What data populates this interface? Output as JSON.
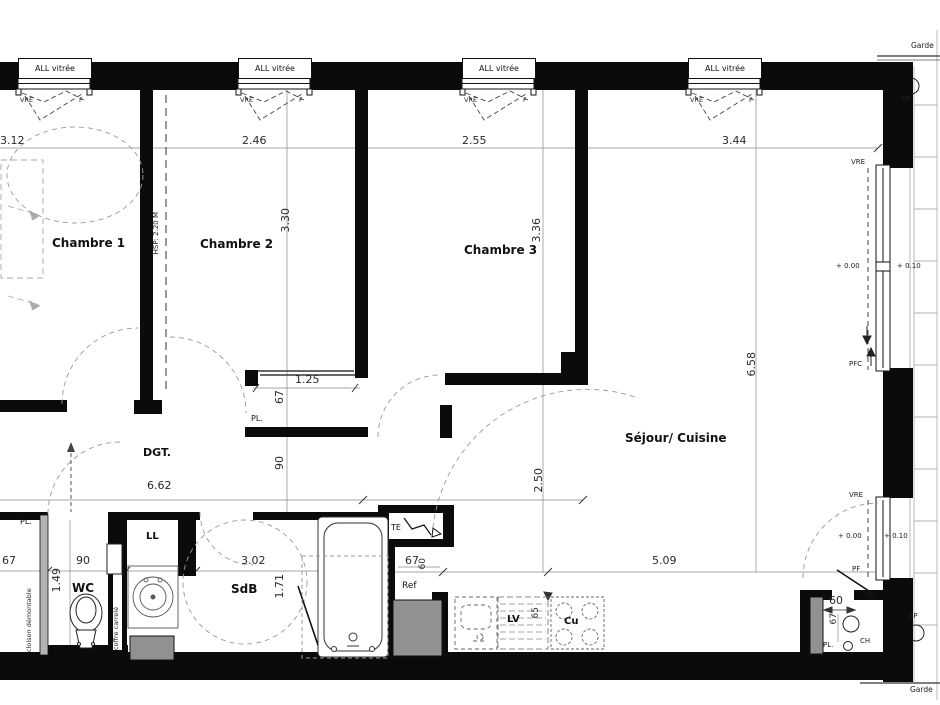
{
  "plan": {
    "window_label": "ALL vitrée",
    "rooms": {
      "chambre1": "Chambre 1",
      "chambre2": "Chambre 2",
      "chambre3": "Chambre 3",
      "sejour": "Séjour/ Cuisine",
      "dgt": "DGT.",
      "wc": "WC",
      "sdb": "SdB"
    },
    "dims": {
      "d312": "3.12",
      "d246": "2.46",
      "d255": "2.55",
      "d344": "3.44",
      "d330": "3.30",
      "d336": "3.36",
      "d658": "6.58",
      "d250": "2.50",
      "d509": "5.09",
      "d662": "6.62",
      "d125": "1.25",
      "d302": "3.02",
      "d171": "1.71",
      "d149": "1.49",
      "d90": "90",
      "d67": "67",
      "d60": "60",
      "d65": "65"
    },
    "ann": {
      "vre": "VRE",
      "f": "F",
      "pfc": "PFC",
      "pf": "PF",
      "lvl0": "+ 0.00",
      "lvl10": "+ 0.10",
      "ep": "EP",
      "garde": "Garde",
      "hsp": "HSP: 2.20 M",
      "cloison": "cloison démontable",
      "coffre": "coffre carrelé",
      "pl": "PL.",
      "ll": "LL",
      "lv": "LV",
      "cu": "Cu",
      "ref": "Ref",
      "te": "TE",
      "ch": "CH"
    }
  }
}
